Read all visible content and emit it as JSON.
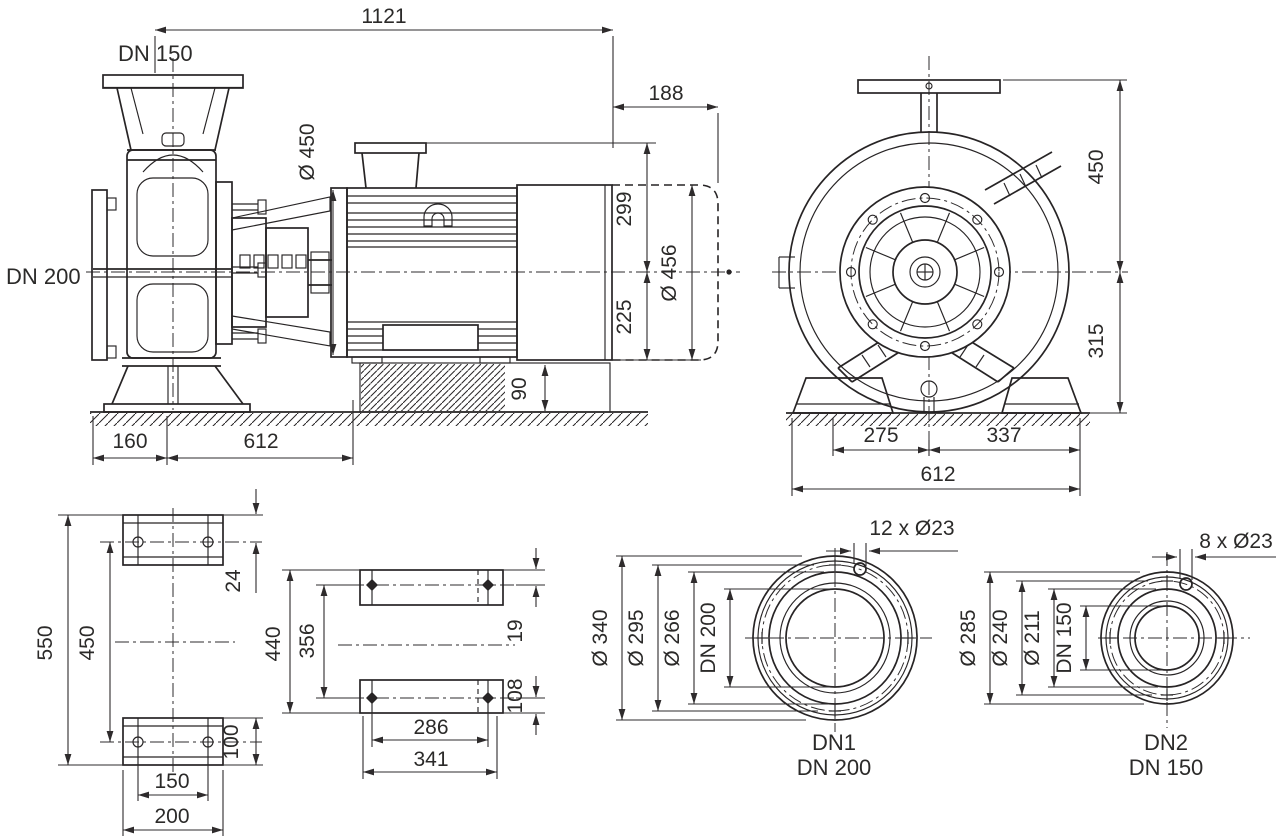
{
  "colors": {
    "background": "#ffffff",
    "line": "#272425",
    "text": "#2b2a29"
  },
  "views": {
    "side": {
      "port_top_label": "DN 150",
      "port_left_label": "DN 200",
      "dim_overall_length": "1121",
      "dim_motor_extension": "188",
      "dim_motor_diameter": "Ø 450",
      "dim_center_to_top": "299",
      "dim_center_to_bottom": "225",
      "dim_alt_motor_diameter": "Ø 456",
      "dim_foundation_height": "90",
      "dim_suction_to_center": "160",
      "dim_base_length": "612"
    },
    "front": {
      "dim_center_to_flange_top": "450",
      "dim_center_to_base": "315",
      "dim_center_to_left_foot": "275",
      "dim_center_to_right_foot": "337",
      "dim_base_width": "612"
    },
    "pedestal": {
      "dim_overall_height": "550",
      "dim_bolt_height": "450",
      "dim_top_pad_offset": "24",
      "dim_bottom_pad_height": "100",
      "dim_bolt_spacing": "150",
      "dim_pad_width": "200"
    },
    "footprint": {
      "dim_overall_width": "440",
      "dim_bolt_span": "356",
      "dim_top_edge_to_bolt": "19",
      "dim_bottom_edge_to_bolt": "108",
      "dim_bolt_spacing": "286",
      "dim_pad_length": "341"
    },
    "flange_dn1": {
      "bolt_callout": "12 x Ø23",
      "dim_outer_diameter": "Ø 340",
      "dim_bolt_circle": "Ø 295",
      "dim_raised_face": "Ø 266",
      "dim_bore": "DN 200",
      "caption_line1": "DN1",
      "caption_line2": "DN 200"
    },
    "flange_dn2": {
      "bolt_callout": "8 x Ø23",
      "dim_outer_diameter": "Ø 285",
      "dim_bolt_circle": "Ø 240",
      "dim_raised_face": "Ø 211",
      "dim_bore": "DN 150",
      "caption_line1": "DN2",
      "caption_line2": "DN 150"
    }
  }
}
